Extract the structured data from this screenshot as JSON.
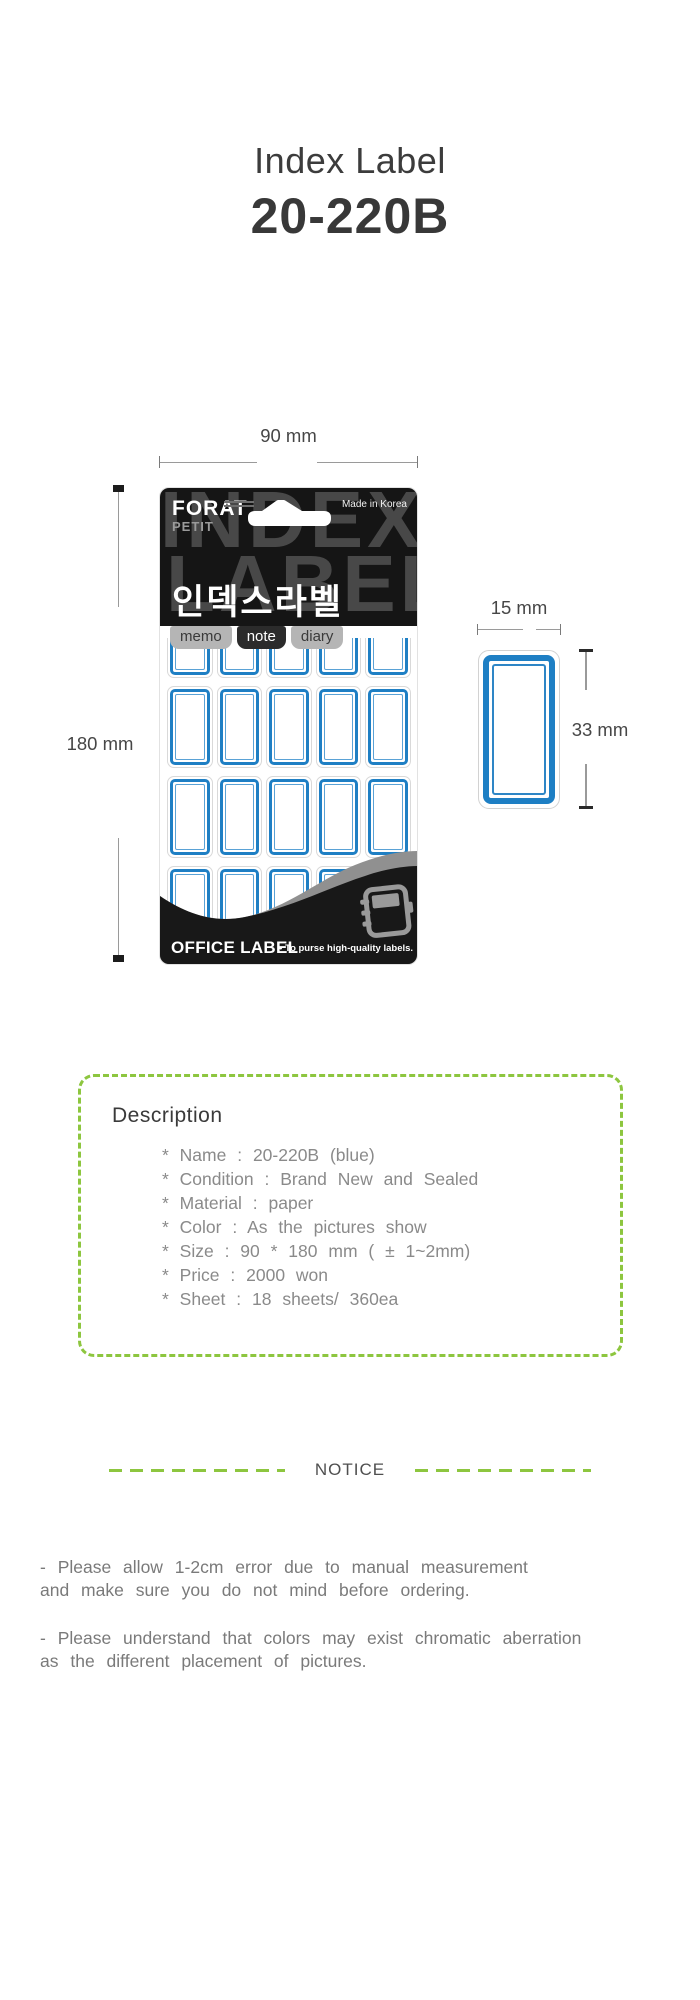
{
  "title": {
    "product": "Index Label",
    "model": "20-220B"
  },
  "figure": {
    "width_label": "90 mm",
    "height_label": "180 mm",
    "package": {
      "brand": "FORAT",
      "brand_sub": "PETIT",
      "made_in": "Made in Korea",
      "watermark": [
        "INDEX",
        "LABEL"
      ],
      "korean_name": "인덱스라벨",
      "tabs": [
        {
          "label": "memo"
        },
        {
          "label": "note"
        },
        {
          "label": "diary"
        }
      ],
      "grid": {
        "columns": 5,
        "rows": 4
      },
      "footer": {
        "brand": "OFFICE LABEL",
        "tagline": "• To purse high-quality labels."
      }
    },
    "single_label": {
      "width_label": "15 mm",
      "height_label": "33 mm"
    }
  },
  "description": {
    "heading": "Description",
    "items": [
      "* Name : 20-220B (blue)",
      "* Condition : Brand New and Sealed",
      "* Material : paper",
      "* Color : As the pictures show",
      "* Size : 90 * 180 mm ( ± 1~2mm)",
      "* Price : 2000 won",
      "* Sheet : 18 sheets/ 360ea"
    ]
  },
  "notice": {
    "label": "NOTICE",
    "paragraphs": [
      {
        "lines": [
          "- Please allow 1-2cm error due to manual measurement",
          "and make sure you do not mind before ordering."
        ]
      },
      {
        "lines": [
          "- Please understand that colors may exist chromatic aberration",
          "as the different placement of pictures."
        ]
      }
    ]
  },
  "colors": {
    "accent_green": "#8dc63f",
    "label_blue": "#1e7fc4",
    "package_black": "#151515",
    "text_dark": "#3c3c3c",
    "text_gray": "#8a8a8a"
  }
}
